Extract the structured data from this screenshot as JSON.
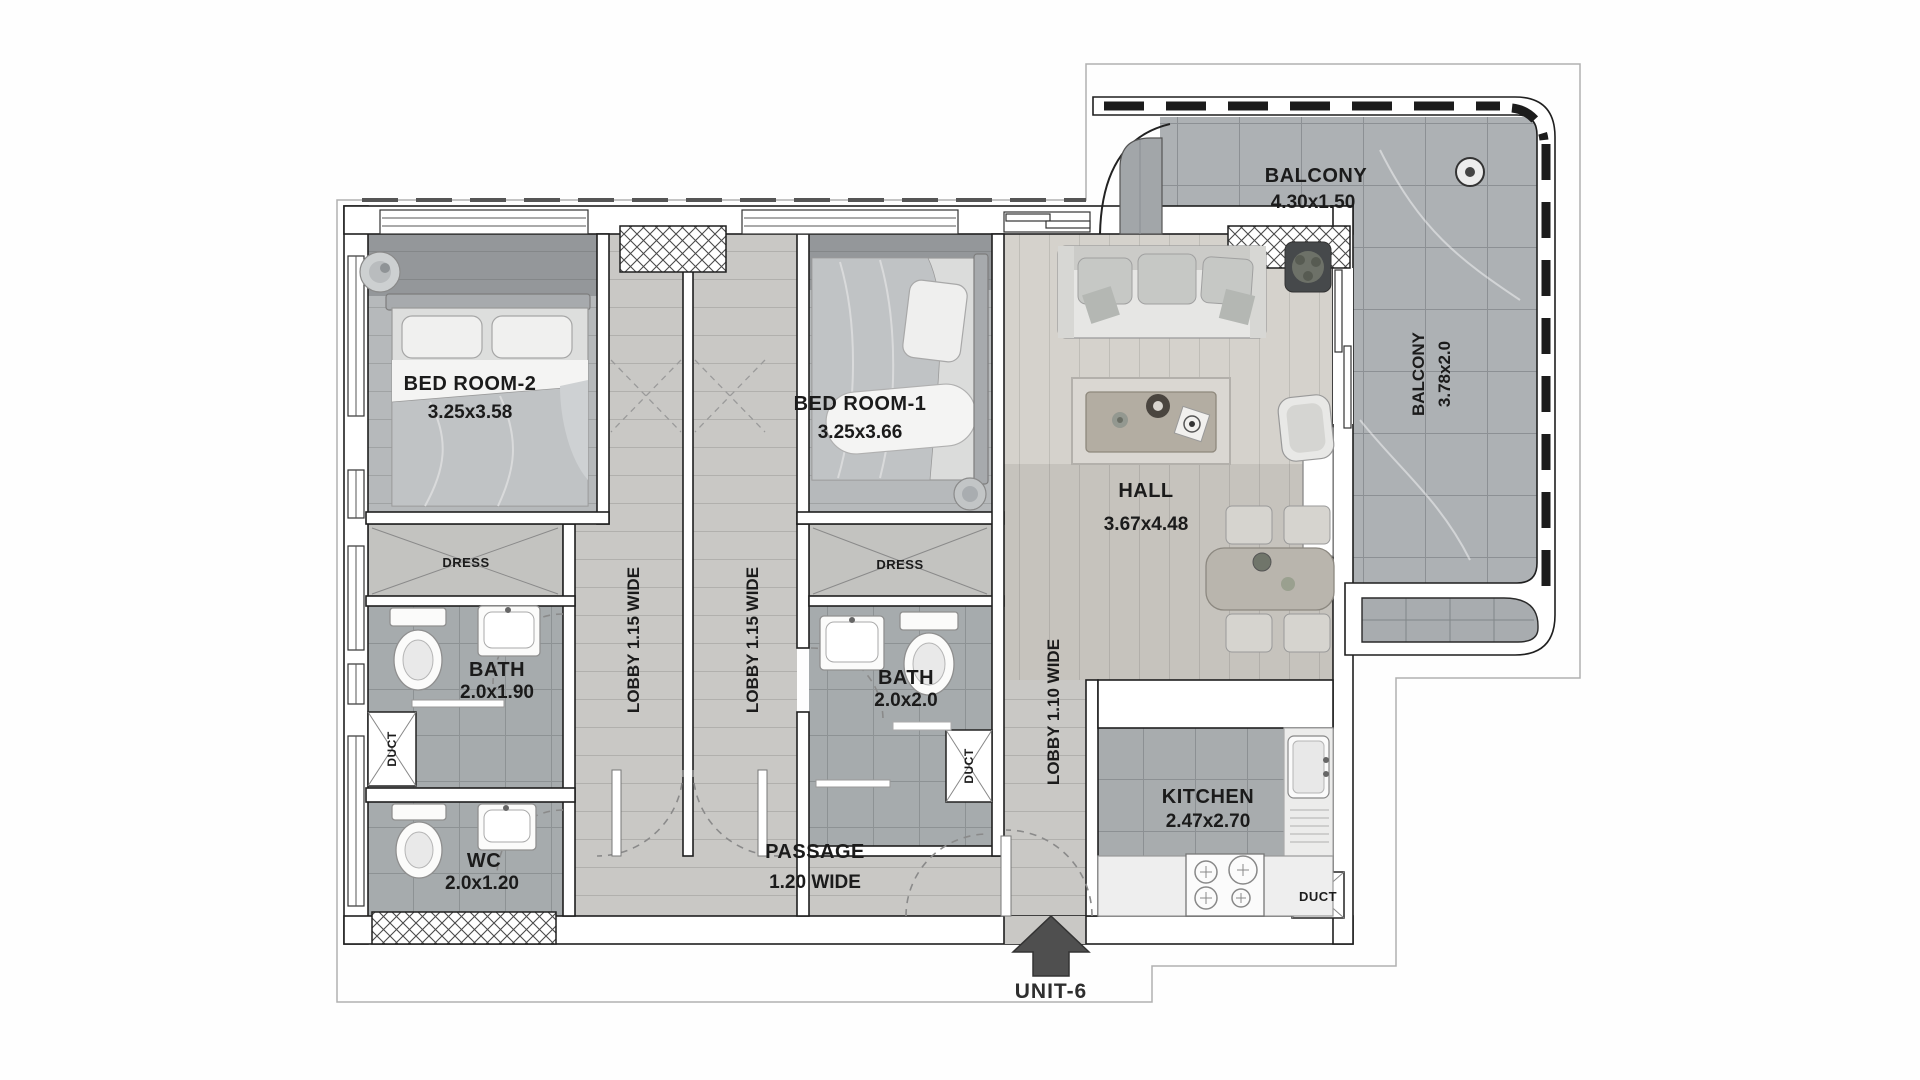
{
  "unit": {
    "label": "UNIT-6"
  },
  "rooms": {
    "bedroom2": {
      "name": "BED ROOM-2",
      "dims": "3.25x3.58"
    },
    "bedroom1": {
      "name": "BED ROOM-1",
      "dims": "3.25x3.66"
    },
    "hall": {
      "name": "HALL",
      "dims": "3.67x4.48"
    },
    "kitchen": {
      "name": "KITCHEN",
      "dims": "2.47x2.70"
    },
    "bath2": {
      "name": "BATH",
      "dims": "2.0x1.90"
    },
    "bath1": {
      "name": "BATH",
      "dims": "2.0x2.0"
    },
    "wc": {
      "name": "WC",
      "dims": "2.0x1.20"
    },
    "passage": {
      "name": "PASSAGE",
      "dims": "1.20 WIDE"
    },
    "balcony_top": {
      "name": "BALCONY",
      "dims": "4.30x1.50"
    },
    "balcony_right": {
      "name": "BALCONY",
      "dims": "3.78x2.0"
    },
    "lobby_a": {
      "name": "LOBBY 1.15 WIDE"
    },
    "lobby_b": {
      "name": "LOBBY 1.15 WIDE"
    },
    "lobby_entry": {
      "name": "LOBBY 1.10 WIDE"
    },
    "dress2": {
      "name": "DRESS"
    },
    "dress1": {
      "name": "DRESS"
    },
    "duct_wc": {
      "name": "DUCT"
    },
    "duct_bath1": {
      "name": "DUCT"
    },
    "duct_kitchen": {
      "name": "DUCT"
    }
  },
  "colors": {
    "wall_stroke": "#1f1f1f",
    "wood_floor": "#b6b9bb",
    "tile_floor": "#abafb2",
    "label_text": "#1b1b1b",
    "arrow": "#4f4f4f"
  }
}
